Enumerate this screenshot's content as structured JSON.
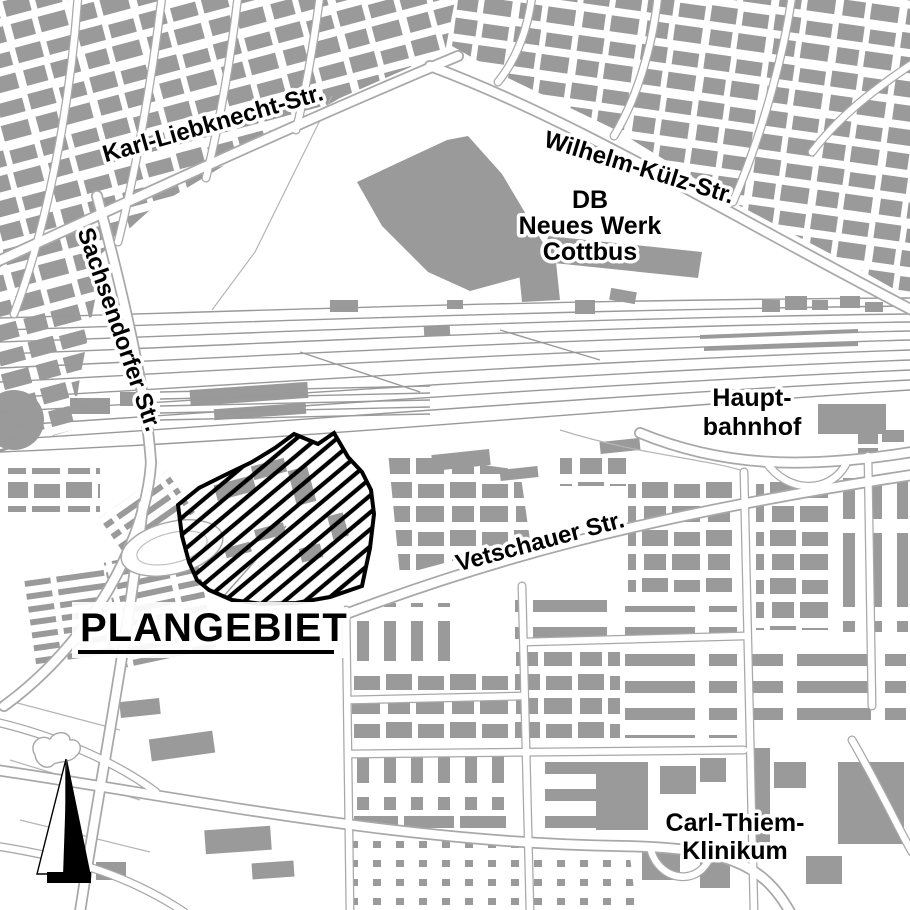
{
  "map_labels": {
    "karl_liebknecht_str": "Karl-Liebknecht-Str.",
    "wilhelm_kuelz_str": "Wilhelm-Külz-Str.",
    "sachsendorfer_str": "Sachsendorfer Str.",
    "db_werk": {
      "line1": "DB",
      "line2": "Neues Werk",
      "line3": "Cottbus"
    },
    "hauptbahnhof": {
      "line1": "Haupt-",
      "line2": "bahnhof"
    },
    "vetschauer_str": "Vetschauer Str.",
    "plangebiet": "PLANGEBIET",
    "carl_thiem_klinikum": {
      "line1": "Carl-Thiem-",
      "line2": "Klinikum"
    }
  },
  "colors": {
    "background": "#ffffff",
    "building": "#9a9a9a",
    "street_casing": "#a8a8a8",
    "railway_track": "#999999",
    "label_text": "#000000",
    "label_halo": "#ffffff",
    "plan_area_outline": "#000000",
    "plan_area_hatch": "#000000",
    "north_arrow": "#000000"
  }
}
